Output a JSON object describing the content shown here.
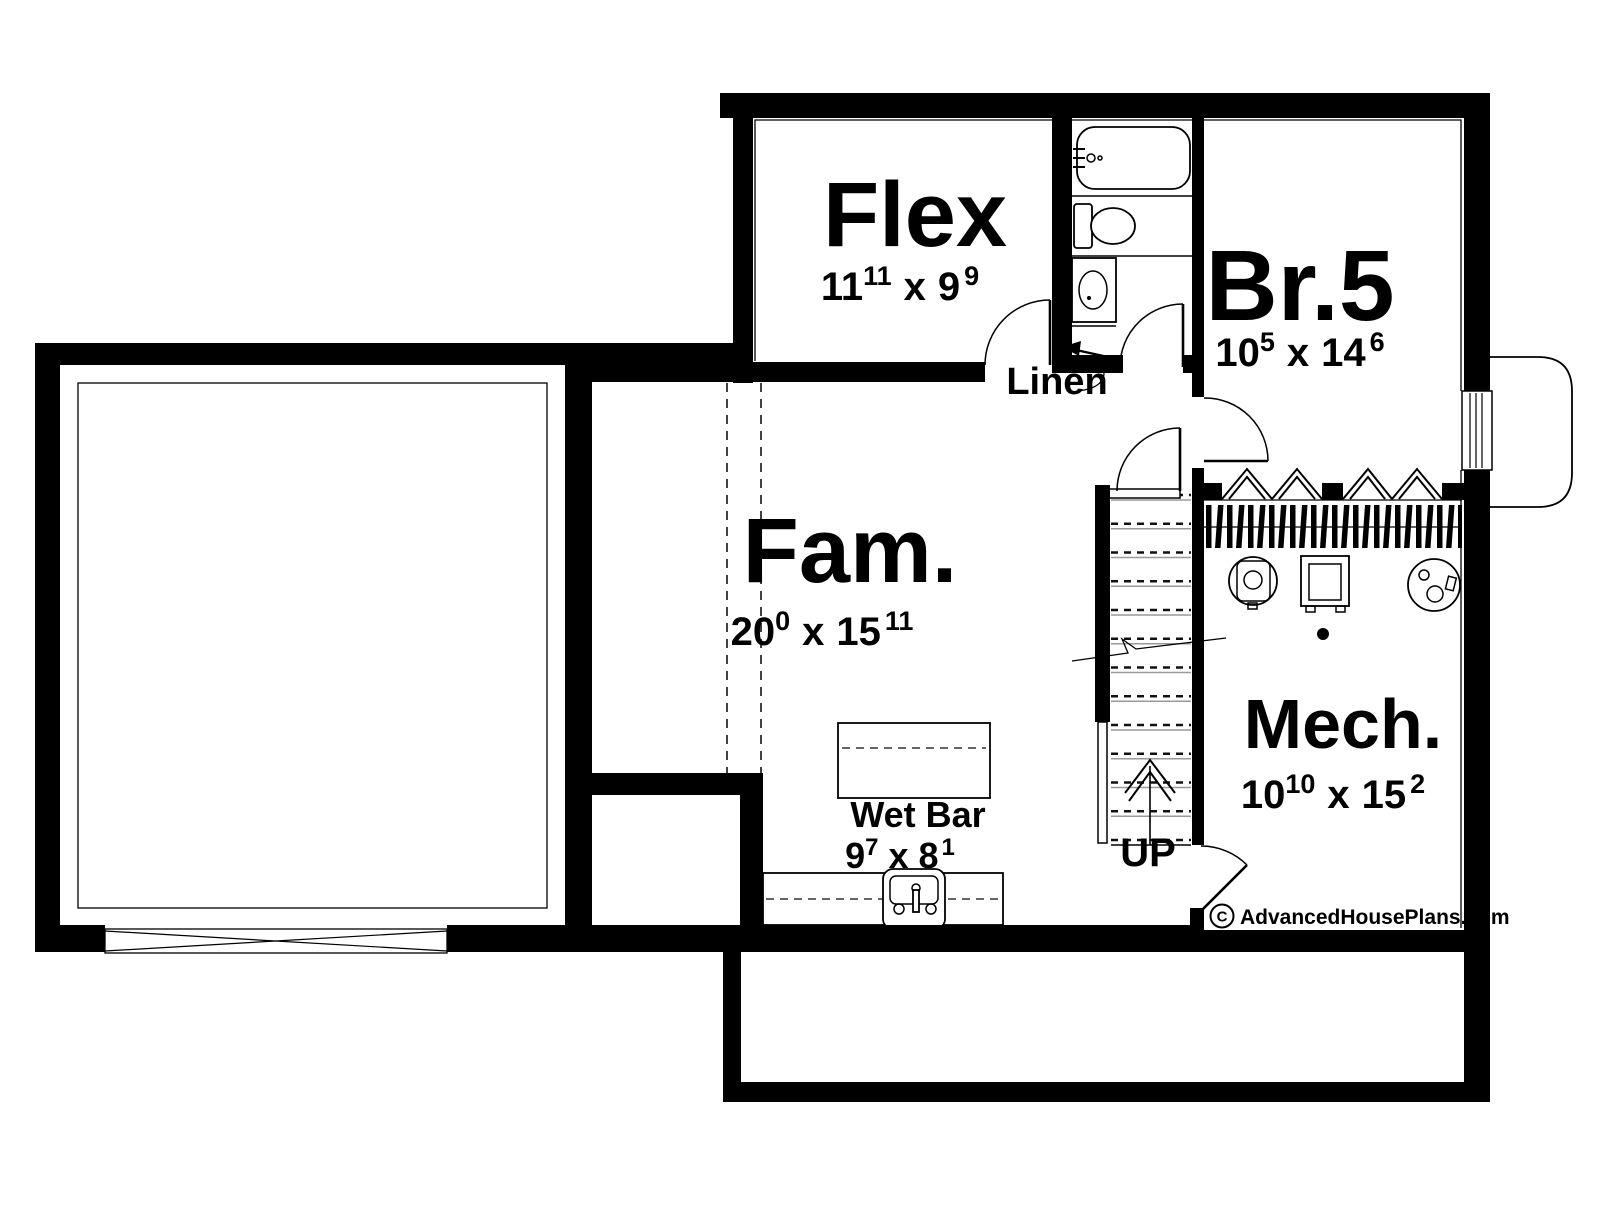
{
  "drawing": {
    "background": "#ffffff",
    "ink": "#000000",
    "watermark": {
      "copyright_symbol": "C",
      "site": "AdvancedHousePlans.com"
    },
    "annotations": {
      "linen": "Linen",
      "stairs_up": "UP",
      "times": "x"
    },
    "rooms": [
      {
        "id": "flex",
        "label": "Flex",
        "width_ft": "11",
        "width_in": "11",
        "depth_ft": "9",
        "depth_in": "9"
      },
      {
        "id": "br5",
        "label": "Br.5",
        "width_ft": "10",
        "width_in": "5",
        "depth_ft": "14",
        "depth_in": "6"
      },
      {
        "id": "fam",
        "label": "Fam.",
        "width_ft": "20",
        "width_in": "0",
        "depth_ft": "15",
        "depth_in": "11"
      },
      {
        "id": "wetbar",
        "label": "Wet Bar",
        "width_ft": "9",
        "width_in": "7",
        "depth_ft": "8",
        "depth_in": "1"
      },
      {
        "id": "mech",
        "label": "Mech.",
        "width_ft": "10",
        "width_in": "10",
        "depth_ft": "15",
        "depth_in": "2"
      }
    ]
  }
}
